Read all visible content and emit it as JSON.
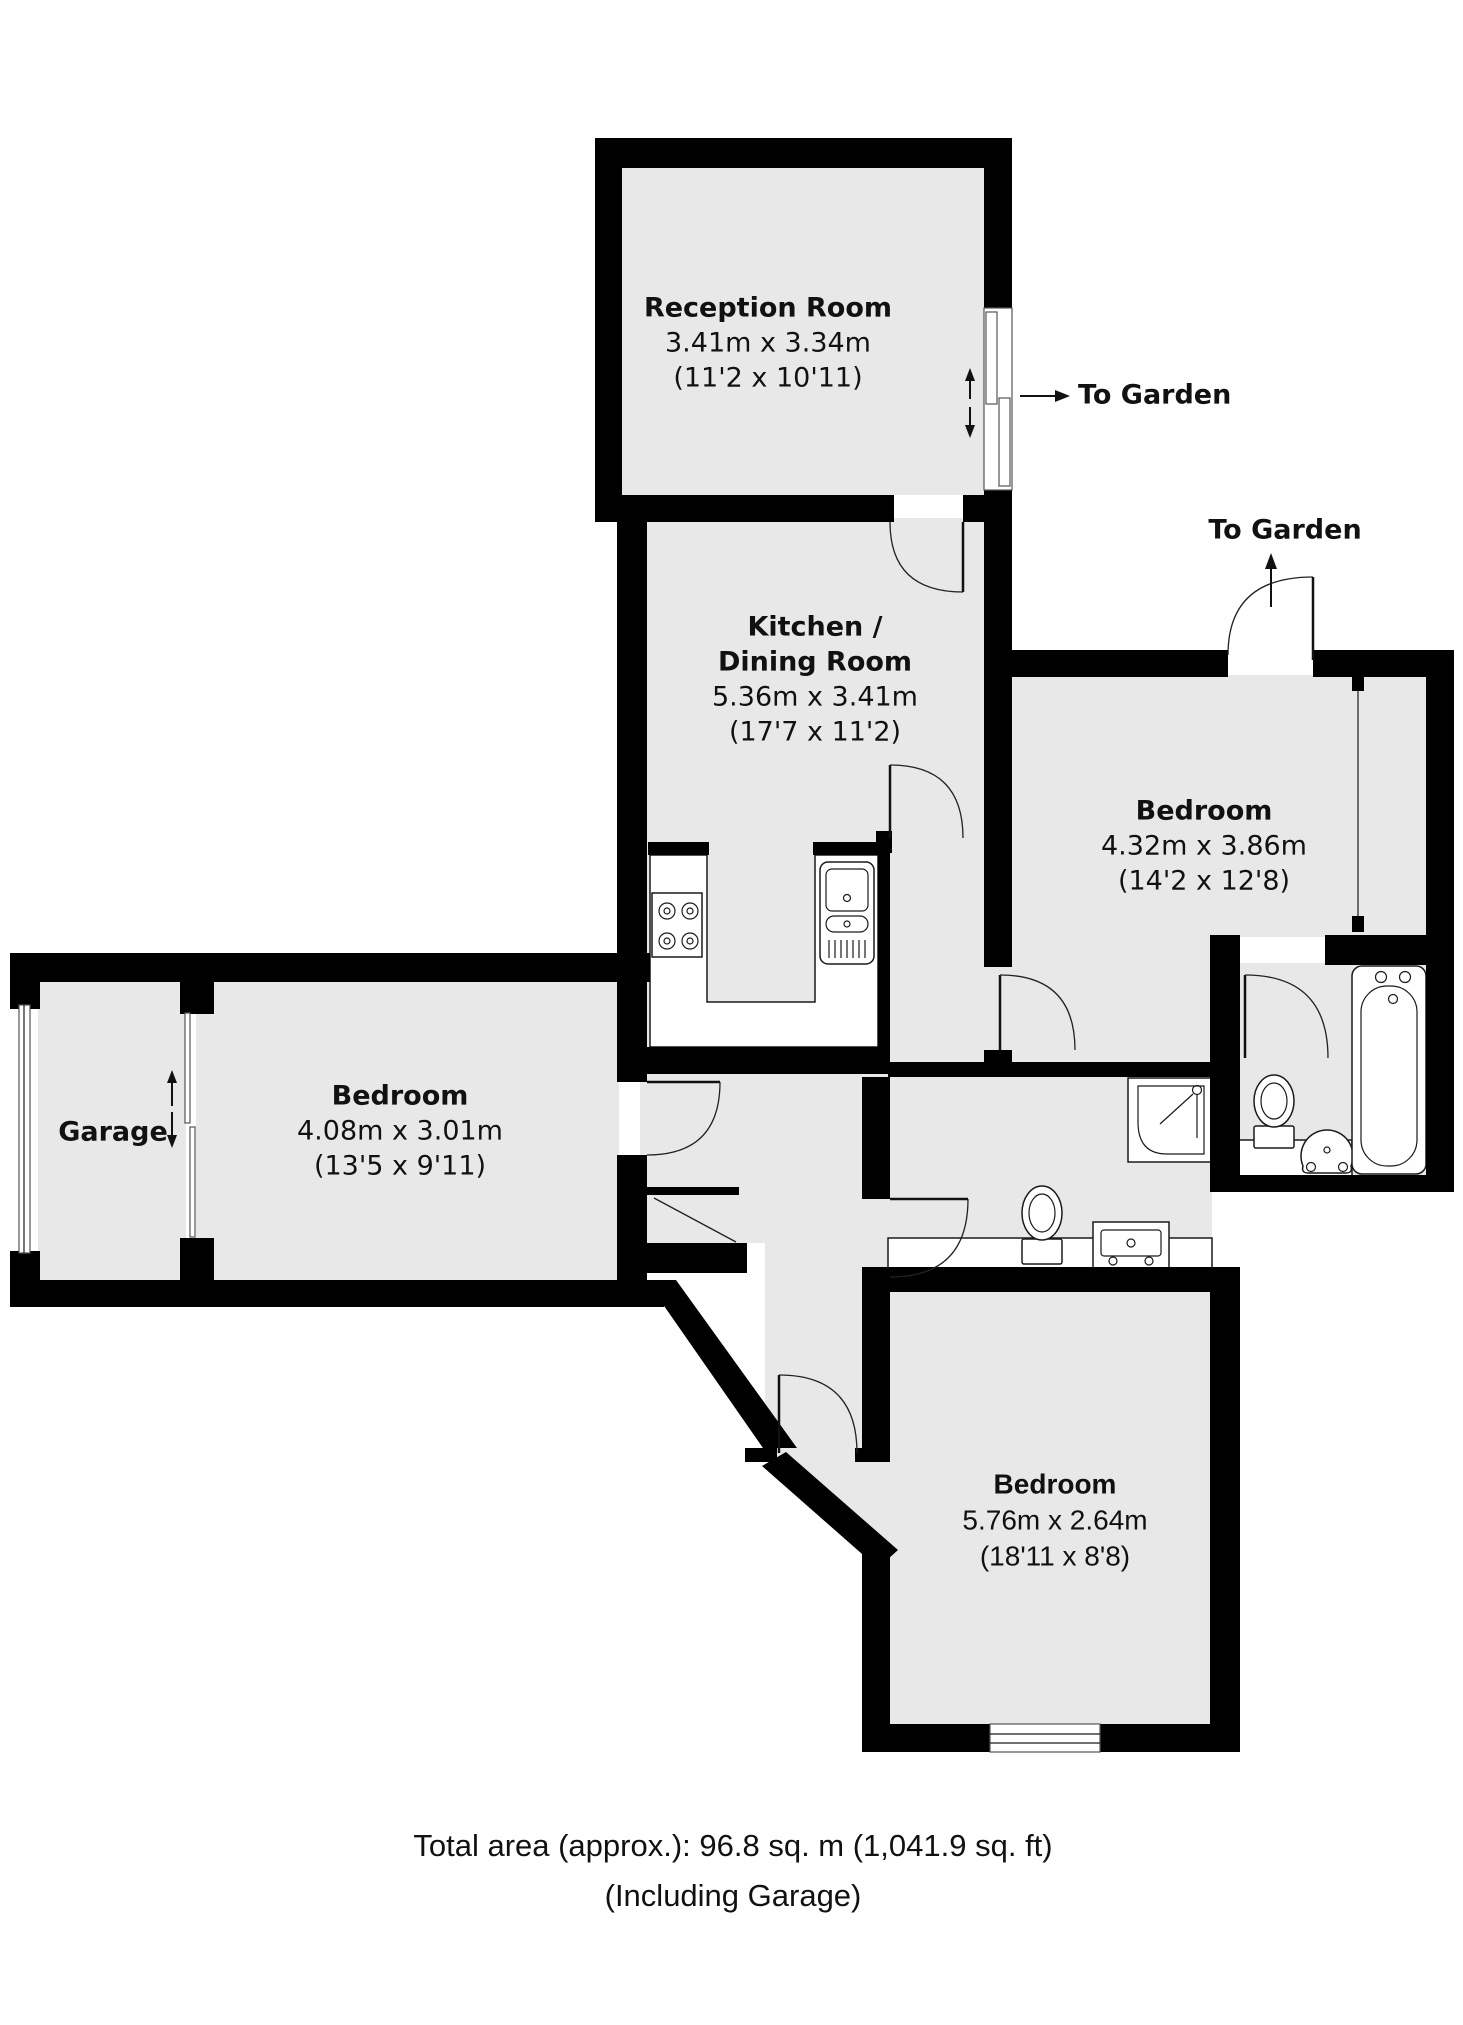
{
  "rooms": {
    "reception": {
      "name": "Reception Room",
      "dims_m": "3.41m x 3.34m",
      "dims_ft": "(11'2 x 10'11)"
    },
    "kitchen": {
      "name_line1": "Kitchen /",
      "name_line2": "Dining Room",
      "dims_m": "5.36m x 3.41m",
      "dims_ft": "(17'7 x 11'2)"
    },
    "bedroom_right": {
      "name": "Bedroom",
      "dims_m": "4.32m x 3.86m",
      "dims_ft": "(14'2 x 12'8)"
    },
    "bedroom_left": {
      "name": "Bedroom",
      "dims_m": "4.08m x 3.01m",
      "dims_ft": "(13'5 x 9'11)"
    },
    "bedroom_bottom": {
      "name": "Bedroom",
      "dims_m": "5.76m x 2.64m",
      "dims_ft": "(18'11 x 8'8)"
    },
    "garage": {
      "name": "Garage"
    }
  },
  "annotations": {
    "to_garden_top": "To Garden",
    "to_garden_right": "To Garden"
  },
  "footer": {
    "line1": "Total area (approx.): 96.8 sq. m (1,041.9 sq. ft)",
    "line2": "(Including Garage)"
  },
  "colors": {
    "wall": "#000000",
    "floor": "#e8e8e8",
    "fixture_line": "#1a1a1a"
  }
}
